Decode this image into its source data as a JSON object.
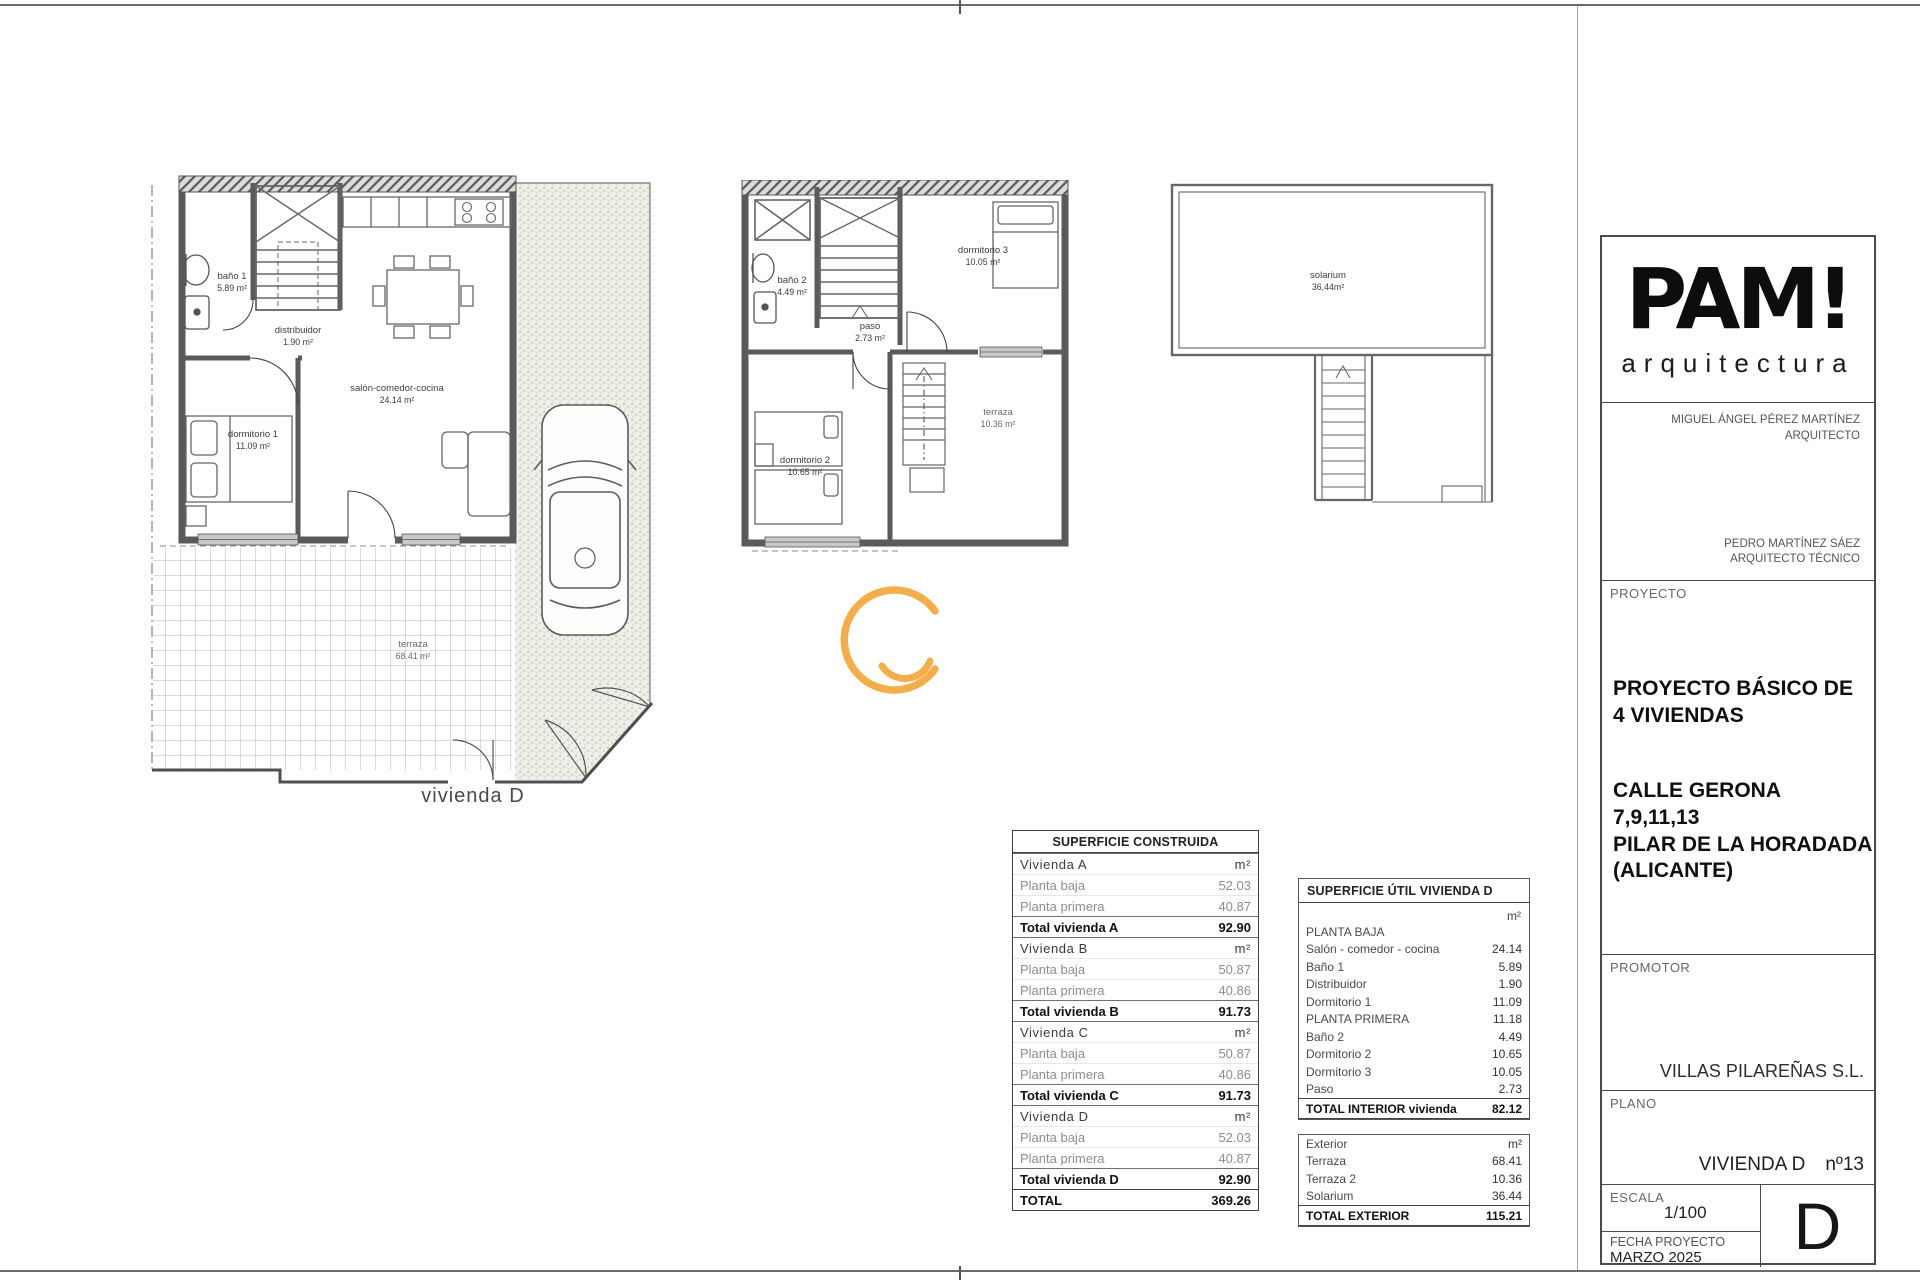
{
  "colors": {
    "accent": "#F3A63C",
    "wall": "#5A5A5A"
  },
  "plans": {
    "ground": {
      "caption": "vivienda D",
      "rooms": {
        "bano": {
          "label": "baño 1",
          "area": "5.89 m²"
        },
        "distribuidor": {
          "label": "distribuidor",
          "area": "1.90 m²"
        },
        "salon": {
          "label": "salón-comedor-cocina",
          "area": "24.14 m²"
        },
        "dormitorio1": {
          "label": "dormitorio 1",
          "area": "11.09 m²"
        },
        "terraza": {
          "label": "terraza",
          "area": "68.41 m²"
        }
      }
    },
    "first": {
      "rooms": {
        "bano2": {
          "label": "baño 2",
          "area": "4.49 m²"
        },
        "paso": {
          "label": "paso",
          "area": "2.73 m²"
        },
        "dormitorio3": {
          "label": "dormitorio 3",
          "area": "10.05 m²"
        },
        "dormitorio2": {
          "label": "dormitorio 2",
          "area": "10.65 m²"
        },
        "terraza2": {
          "label": "terraza",
          "area": "10.36 m²"
        }
      }
    },
    "roof": {
      "rooms": {
        "solarium": {
          "label": "solarium",
          "area": "36,44m²"
        }
      }
    }
  },
  "tables": {
    "construida": {
      "title": "SUPERFICIE CONSTRUIDA",
      "groups": [
        {
          "name": "Vivienda A",
          "unit": "m²",
          "rows": [
            [
              "Planta baja",
              "52.03"
            ],
            [
              "Planta primera",
              "40.87"
            ]
          ],
          "total_label": "Total vivienda A",
          "total": "92.90"
        },
        {
          "name": "Vivienda B",
          "unit": "m²",
          "rows": [
            [
              "Planta baja",
              "50.87"
            ],
            [
              "Planta primera",
              "40.86"
            ]
          ],
          "total_label": "Total vivienda B",
          "total": "91.73"
        },
        {
          "name": "Vivienda C",
          "unit": "m²",
          "rows": [
            [
              "Planta baja",
              "50.87"
            ],
            [
              "Planta primera",
              "40.86"
            ]
          ],
          "total_label": "Total vivienda C",
          "total": "91.73"
        },
        {
          "name": "Vivienda D",
          "unit": "m²",
          "rows": [
            [
              "Planta baja",
              "52.03"
            ],
            [
              "Planta primera",
              "40.87"
            ]
          ],
          "total_label": "Total vivienda D",
          "total": "92.90"
        }
      ],
      "total_label": "TOTAL",
      "total": "369.26"
    },
    "util": {
      "title": "SUPERFICIE ÚTIL VIVIENDA D",
      "unit": "m²",
      "rows": [
        [
          "PLANTA BAJA",
          ""
        ],
        [
          "Salón - comedor - cocina",
          "24.14"
        ],
        [
          "Baño 1",
          "5.89"
        ],
        [
          "Distribuidor",
          "1.90"
        ],
        [
          "Dormitorio 1",
          "11.09"
        ],
        [
          "PLANTA PRIMERA",
          "11.18"
        ],
        [
          "Baño 2",
          "4.49"
        ],
        [
          "Dormitorio 2",
          "10.65"
        ],
        [
          "Dormitorio 3",
          "10.05"
        ],
        [
          "Paso",
          "2.73"
        ]
      ],
      "total_label": "TOTAL INTERIOR vivienda",
      "total": "82.12",
      "exterior": {
        "header": "Exterior",
        "unit": "m²",
        "rows": [
          [
            "Terraza",
            "68.41"
          ],
          [
            "Terraza 2",
            "10.36"
          ],
          [
            "Solarium",
            "36.44"
          ]
        ],
        "total_label": "TOTAL EXTERIOR",
        "total": "115.21"
      }
    }
  },
  "titleblock": {
    "logo": "PAM!",
    "logo_sub": "arquitectura",
    "architect1": "MIGUEL ÁNGEL PÉREZ MARTÍNEZ",
    "architect1_role": "ARQUITECTO",
    "architect2": "PEDRO MARTÍNEZ SÁEZ",
    "architect2_role": "ARQUITECTO TÉCNICO",
    "proyecto_label": "PROYECTO",
    "pb1": "PROYECTO BÁSICO DE",
    "pb2": "4 VIVIENDAS",
    "ad1": "CALLE GERONA",
    "ad2": "7,9,11,13",
    "ad3": "PILAR DE LA HORADADA",
    "ad4": "(ALICANTE)",
    "promotor_label": "PROMOTOR",
    "promotor": "VILLAS PILAREÑAS S.L.",
    "plano_label": "PLANO",
    "plano": "VIVIENDA D",
    "plano_num": "nº13",
    "escala_label": "ESCALA",
    "escala": "1/100",
    "fecha_label": "FECHA PROYECTO",
    "fecha": "MARZO 2025",
    "sheet_letter": "D"
  }
}
